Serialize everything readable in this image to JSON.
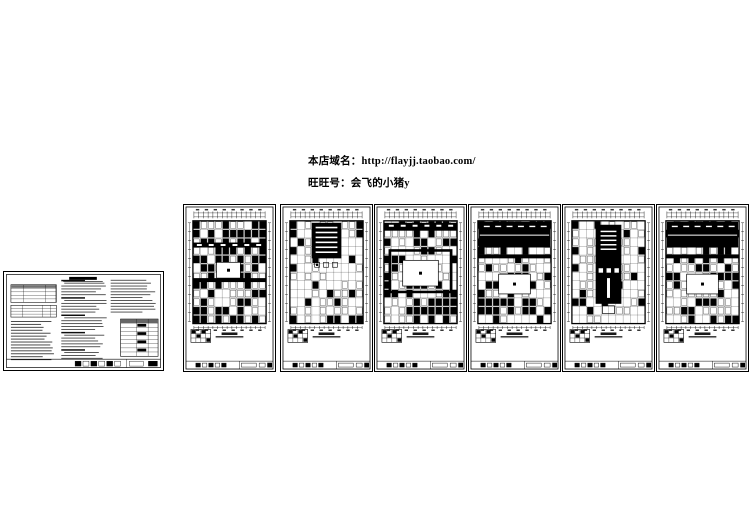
{
  "header": {
    "domain_line": "本店域名：http://flayjj.taobao.com/",
    "wangwang_line": "旺旺号：会飞的小猪y"
  },
  "colors": {
    "ink": "#000000",
    "paper": "#ffffff"
  },
  "sheets": {
    "notes_sheet_count": 1,
    "plan_sheet_count": 6
  }
}
